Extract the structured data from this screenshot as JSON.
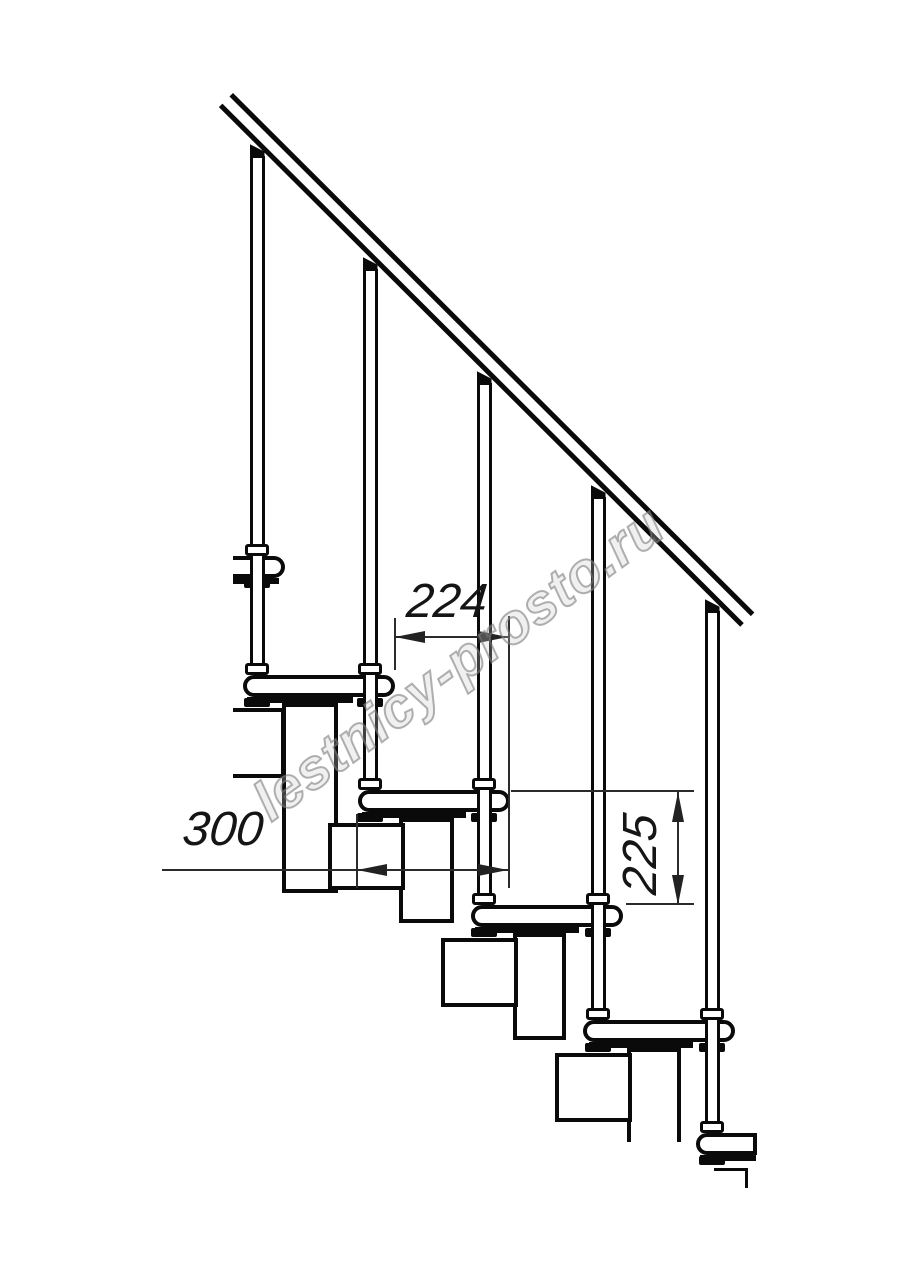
{
  "page": {
    "background": "#ffffff"
  },
  "drawing": {
    "description": "Side elevation of a modular staircase: sloped handrail, five balusters, step treads and zigzag stringer modules",
    "line_color": "#0a0a0a",
    "dimension_color": "#2b2b2b"
  },
  "dimensions": {
    "step_going": "224",
    "tread_length": "300",
    "step_rise": "225"
  },
  "watermark": {
    "text": "lestnicy-prosto.ru",
    "color": "#9a9a9a"
  }
}
